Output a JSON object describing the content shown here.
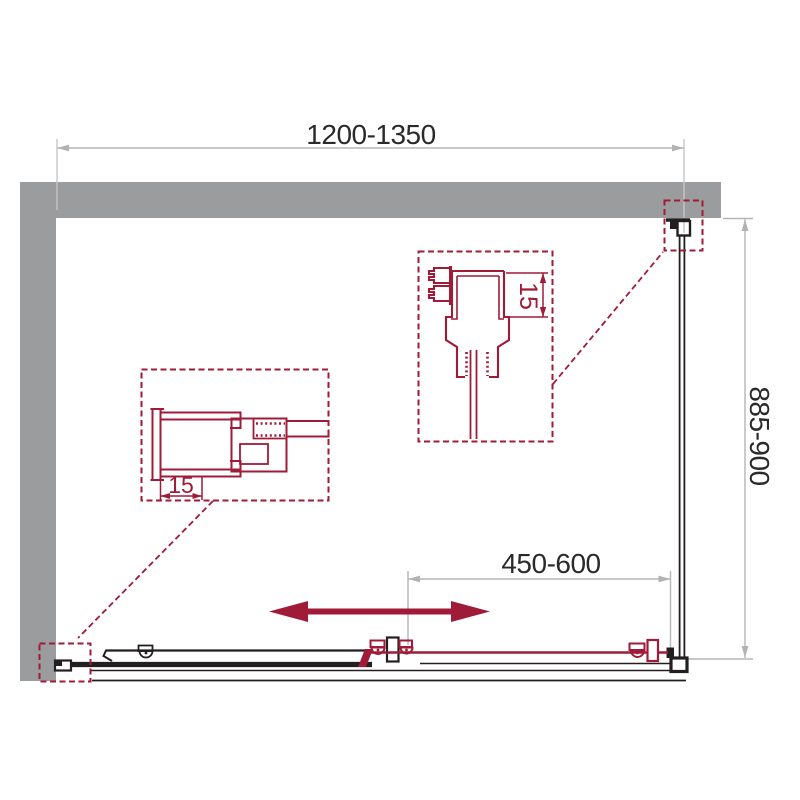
{
  "drawing": {
    "colors": {
      "wall": "#9b9c9e",
      "accent": "#a01b38",
      "line": "#231f20",
      "dimension": "#b4b6b7"
    },
    "dimensions": {
      "width": {
        "label": "1200-1350"
      },
      "depth": {
        "label": "885-900"
      },
      "door_travel": {
        "label": "450-600"
      },
      "detail_top_offset": {
        "label": "15"
      },
      "detail_side_offset": {
        "label": "15"
      }
    }
  }
}
